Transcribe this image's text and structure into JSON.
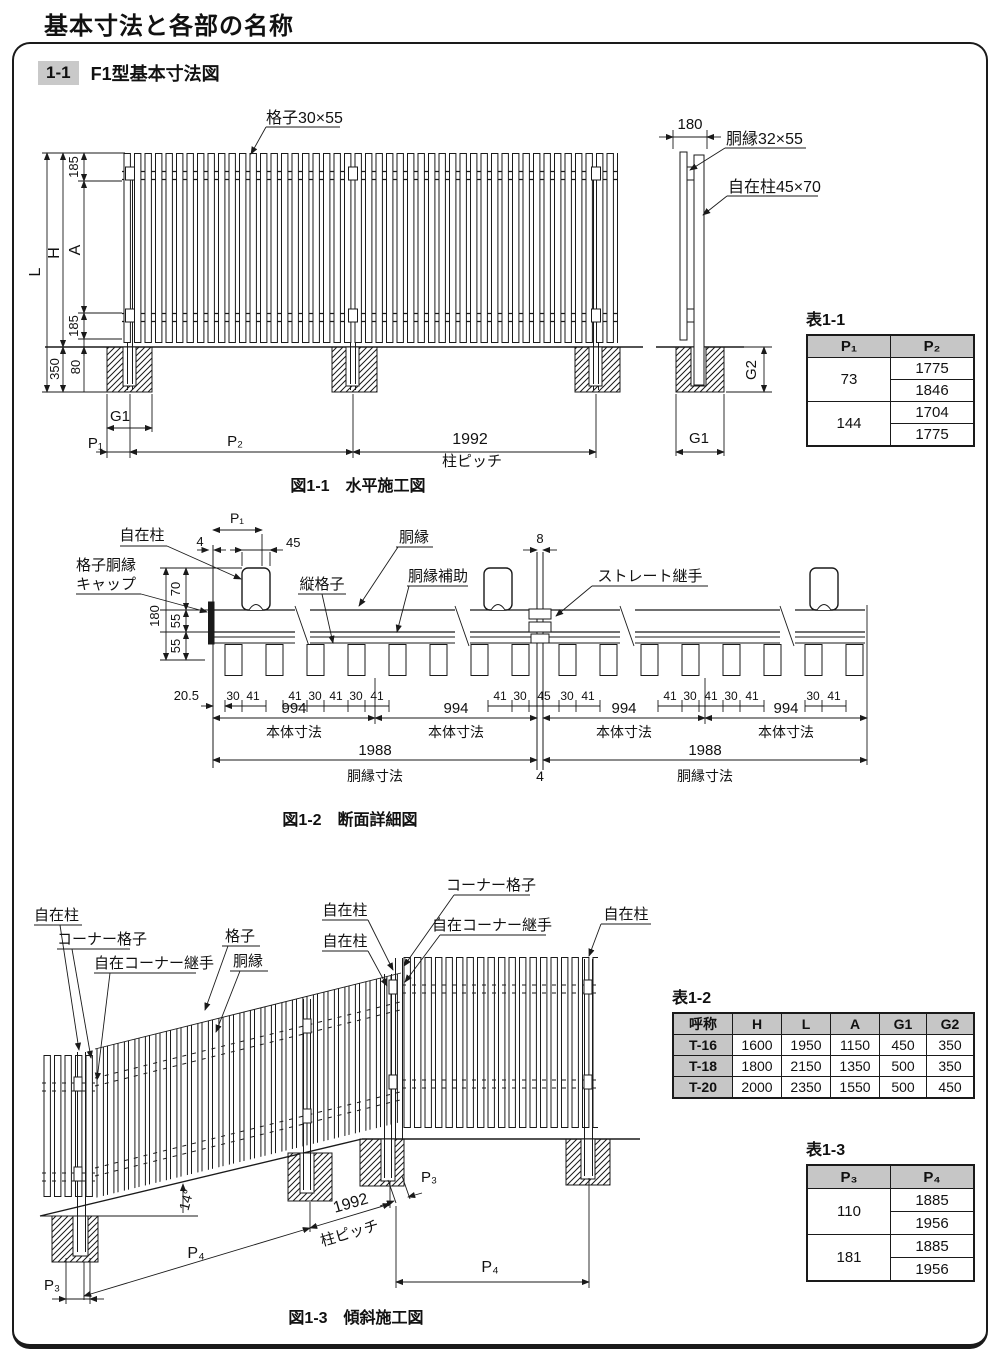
{
  "page": {
    "title": "基本寸法と各部の名称",
    "section_no": "1-1",
    "section_title": "F1型基本寸法図"
  },
  "colors": {
    "line": "#1a1a1a",
    "table_header_bg": "#c6c6c6",
    "badge_bg": "#c9c9c9"
  },
  "fig1": {
    "caption": "図1-1　水平施工図",
    "annotations": [
      {
        "n": "label-lattice-size",
        "t": "格子30×55",
        "x": 266,
        "y": 123,
        "a": "start",
        "s": 16
      },
      {
        "n": "dim-L",
        "t": "L",
        "x": 40,
        "y": 272,
        "r": -90,
        "s": 16
      },
      {
        "n": "dim-H",
        "t": "H",
        "x": 59,
        "y": 253,
        "r": -90,
        "s": 16
      },
      {
        "n": "dim-A",
        "t": "A",
        "x": 80,
        "y": 250,
        "r": -90,
        "s": 16
      },
      {
        "n": "dim-185-top",
        "t": "185",
        "x": 78,
        "y": 167,
        "r": -90
      },
      {
        "n": "dim-185-bottom",
        "t": "185",
        "x": 78,
        "y": 326,
        "r": -90
      },
      {
        "n": "dim-80",
        "t": "80",
        "x": 80,
        "y": 367,
        "r": -90
      },
      {
        "n": "dim-350",
        "t": "350",
        "x": 59,
        "y": 369,
        "r": -90
      },
      {
        "n": "dim-G1",
        "t": "G1",
        "x": 120,
        "y": 421,
        "s": 15
      },
      {
        "n": "dim-P1",
        "t": "P₁",
        "x": 103,
        "y": 448,
        "a": "end",
        "s": 15
      },
      {
        "n": "dim-P2",
        "t": "P₂",
        "x": 235,
        "y": 446,
        "s": 15
      },
      {
        "n": "dim-1992",
        "t": "1992",
        "x": 470,
        "y": 444,
        "s": 16
      },
      {
        "n": "label-post-pitch",
        "t": "柱ピッチ",
        "x": 472,
        "y": 466,
        "s": 15
      },
      {
        "n": "dim-180",
        "t": "180",
        "x": 690,
        "y": 129,
        "s": 15
      },
      {
        "n": "label-rail-size",
        "t": "胴縁32×55",
        "x": 726,
        "y": 144,
        "a": "start",
        "s": 16
      },
      {
        "n": "label-free-post-size",
        "t": "自在柱45×70",
        "x": 728,
        "y": 192,
        "a": "start",
        "s": 16
      },
      {
        "n": "dim-G2",
        "t": "G2",
        "x": 756,
        "y": 370,
        "r": -90,
        "s": 15
      },
      {
        "n": "dim-G1-side",
        "t": "G1",
        "x": 699,
        "y": 443,
        "s": 15
      }
    ]
  },
  "fig2": {
    "caption": "図1-2　断面詳細図",
    "annotations": [
      {
        "n": "label-free-post",
        "t": "自在柱",
        "x": 142,
        "y": 540,
        "s": 15
      },
      {
        "n": "label-cap-line1",
        "t": "格子胴縁",
        "x": 76,
        "y": 570,
        "a": "start",
        "s": 15
      },
      {
        "n": "label-cap-line2",
        "t": "キャップ",
        "x": 76,
        "y": 589,
        "a": "start",
        "s": 15
      },
      {
        "n": "dim-P1",
        "t": "P₁",
        "x": 237,
        "y": 523,
        "s": 14
      },
      {
        "n": "dim-4",
        "t": "4",
        "x": 200,
        "y": 546
      },
      {
        "n": "dim-45",
        "t": "45",
        "x": 286,
        "y": 547,
        "a": "start"
      },
      {
        "n": "label-vertical-lattice",
        "t": "縦格子",
        "x": 322,
        "y": 589,
        "s": 15
      },
      {
        "n": "label-rail",
        "t": "胴縁",
        "x": 414,
        "y": 542,
        "s": 15
      },
      {
        "n": "label-rail-aux",
        "t": "胴縁補助",
        "x": 438,
        "y": 581,
        "s": 15
      },
      {
        "n": "dim-8",
        "t": "8",
        "x": 540,
        "y": 543
      },
      {
        "n": "label-straight-joint",
        "t": "ストレート継手",
        "x": 650,
        "y": 581,
        "s": 15
      },
      {
        "n": "dim-180",
        "t": "180",
        "x": 159,
        "y": 616,
        "r": -90
      },
      {
        "n": "dim-70",
        "t": "70",
        "x": 180,
        "y": 589,
        "r": -90
      },
      {
        "n": "dim-55a",
        "t": "55",
        "x": 180,
        "y": 621,
        "r": -90
      },
      {
        "n": "dim-55b",
        "t": "55",
        "x": 180,
        "y": 646,
        "r": -90
      },
      {
        "n": "dim-20-5",
        "t": "20.5",
        "x": 199,
        "y": 700,
        "a": "end"
      },
      {
        "n": "dim-30",
        "t": "30",
        "x": 233,
        "y": 700,
        "s": 12
      },
      {
        "n": "dim-41",
        "t": "41",
        "x": 253,
        "y": 700,
        "s": 12
      },
      {
        "n": "dim-41",
        "t": "41",
        "x": 295,
        "y": 700,
        "s": 12
      },
      {
        "n": "dim-30",
        "t": "30",
        "x": 315,
        "y": 700,
        "s": 12
      },
      {
        "n": "dim-41",
        "t": "41",
        "x": 336,
        "y": 700,
        "s": 12
      },
      {
        "n": "dim-30",
        "t": "30",
        "x": 356,
        "y": 700,
        "s": 12
      },
      {
        "n": "dim-41",
        "t": "41",
        "x": 377,
        "y": 700,
        "s": 12
      },
      {
        "n": "dim-41",
        "t": "41",
        "x": 500,
        "y": 700,
        "s": 12
      },
      {
        "n": "dim-30",
        "t": "30",
        "x": 520,
        "y": 700,
        "s": 12
      },
      {
        "n": "dim-45",
        "t": "45",
        "x": 544,
        "y": 700,
        "s": 12
      },
      {
        "n": "dim-30",
        "t": "30",
        "x": 567,
        "y": 700,
        "s": 12
      },
      {
        "n": "dim-41",
        "t": "41",
        "x": 588,
        "y": 700,
        "s": 12
      },
      {
        "n": "dim-41",
        "t": "41",
        "x": 670,
        "y": 700,
        "s": 12
      },
      {
        "n": "dim-30",
        "t": "30",
        "x": 690,
        "y": 700,
        "s": 12
      },
      {
        "n": "dim-41",
        "t": "41",
        "x": 711,
        "y": 700,
        "s": 12
      },
      {
        "n": "dim-30",
        "t": "30",
        "x": 731,
        "y": 700,
        "s": 12
      },
      {
        "n": "dim-41",
        "t": "41",
        "x": 752,
        "y": 700,
        "s": 12
      },
      {
        "n": "dim-30",
        "t": "30",
        "x": 813,
        "y": 700,
        "s": 12
      },
      {
        "n": "dim-41",
        "t": "41",
        "x": 834,
        "y": 700,
        "s": 12
      },
      {
        "n": "dim-994",
        "t": "994",
        "x": 294,
        "y": 713,
        "s": 15
      },
      {
        "n": "dim-994",
        "t": "994",
        "x": 456,
        "y": 713,
        "s": 15
      },
      {
        "n": "dim-994",
        "t": "994",
        "x": 624,
        "y": 713,
        "s": 15
      },
      {
        "n": "dim-994",
        "t": "994",
        "x": 786,
        "y": 713,
        "s": 15
      },
      {
        "n": "label-body-dim",
        "t": "本体寸法",
        "x": 294,
        "y": 737,
        "s": 14
      },
      {
        "n": "label-body-dim",
        "t": "本体寸法",
        "x": 456,
        "y": 737,
        "s": 14
      },
      {
        "n": "label-body-dim",
        "t": "本体寸法",
        "x": 624,
        "y": 737,
        "s": 14
      },
      {
        "n": "label-body-dim",
        "t": "本体寸法",
        "x": 786,
        "y": 737,
        "s": 14
      },
      {
        "n": "dim-1988",
        "t": "1988",
        "x": 375,
        "y": 755,
        "s": 15
      },
      {
        "n": "dim-1988",
        "t": "1988",
        "x": 705,
        "y": 755,
        "s": 15
      },
      {
        "n": "label-rail-dim",
        "t": "胴縁寸法",
        "x": 375,
        "y": 781,
        "s": 14
      },
      {
        "n": "dim-4-joint",
        "t": "4",
        "x": 540,
        "y": 781,
        "s": 14
      },
      {
        "n": "label-rail-dim",
        "t": "胴縁寸法",
        "x": 705,
        "y": 781,
        "s": 14
      }
    ]
  },
  "fig3": {
    "caption": "図1-3　傾斜施工図",
    "annotations": [
      {
        "n": "label-free-post",
        "t": "自在柱",
        "x": 34,
        "y": 920,
        "a": "start",
        "s": 15
      },
      {
        "n": "label-corner-lattice",
        "t": "コーナー格子",
        "x": 57,
        "y": 944,
        "a": "start",
        "s": 15
      },
      {
        "n": "label-corner-joint",
        "t": "自在コーナー継手",
        "x": 94,
        "y": 968,
        "a": "start",
        "s": 15
      },
      {
        "n": "label-lattice",
        "t": "格子",
        "x": 240,
        "y": 941,
        "s": 15
      },
      {
        "n": "label-rail",
        "t": "胴縁",
        "x": 248,
        "y": 966,
        "s": 15
      },
      {
        "n": "label-free-post",
        "t": "自在柱",
        "x": 345,
        "y": 915,
        "s": 15
      },
      {
        "n": "label-free-post",
        "t": "自在柱",
        "x": 345,
        "y": 946,
        "s": 15
      },
      {
        "n": "label-corner-lattice",
        "t": "コーナー格子",
        "x": 491,
        "y": 890,
        "s": 15
      },
      {
        "n": "label-corner-joint",
        "t": "自在コーナー継手",
        "x": 492,
        "y": 930,
        "s": 15
      },
      {
        "n": "label-free-post",
        "t": "自在柱",
        "x": 626,
        "y": 919,
        "s": 15
      },
      {
        "n": "dim-angle",
        "t": "14°",
        "x": 191,
        "y": 1201,
        "r": -75,
        "s": 14
      },
      {
        "n": "dim-P4-slope",
        "t": "P₄",
        "x": 196,
        "y": 1258,
        "s": 16
      },
      {
        "n": "dim-1992",
        "t": "1992",
        "x": 352,
        "y": 1208,
        "r": -16,
        "s": 16
      },
      {
        "n": "label-post-pitch",
        "t": "柱ピッチ",
        "x": 351,
        "y": 1238,
        "r": -16,
        "s": 15
      },
      {
        "n": "dim-P3-left",
        "t": "P₃",
        "x": 52,
        "y": 1290,
        "s": 15
      },
      {
        "n": "dim-P3-right",
        "t": "P₃",
        "x": 429,
        "y": 1182,
        "s": 15
      },
      {
        "n": "dim-P4-right",
        "t": "P₄",
        "x": 490,
        "y": 1272,
        "s": 16
      }
    ]
  },
  "table1": {
    "title": "表1-1",
    "col_headers": [
      "P₁",
      "P₂"
    ],
    "rows": [
      {
        "p1": "73",
        "p2": [
          "1775",
          "1846"
        ]
      },
      {
        "p1": "144",
        "p2": [
          "1704",
          "1775"
        ]
      }
    ]
  },
  "table2": {
    "title": "表1-2",
    "col_headers": [
      "呼称",
      "H",
      "L",
      "A",
      "G1",
      "G2"
    ],
    "rows": [
      [
        "T-16",
        "1600",
        "1950",
        "1150",
        "450",
        "350"
      ],
      [
        "T-18",
        "1800",
        "2150",
        "1350",
        "500",
        "350"
      ],
      [
        "T-20",
        "2000",
        "2350",
        "1550",
        "500",
        "450"
      ]
    ]
  },
  "table3": {
    "title": "表1-3",
    "col_headers": [
      "P₃",
      "P₄"
    ],
    "rows": [
      {
        "p": "110",
        "vals": [
          "1885",
          "1956"
        ]
      },
      {
        "p": "181",
        "vals": [
          "1885",
          "1956"
        ]
      }
    ]
  }
}
